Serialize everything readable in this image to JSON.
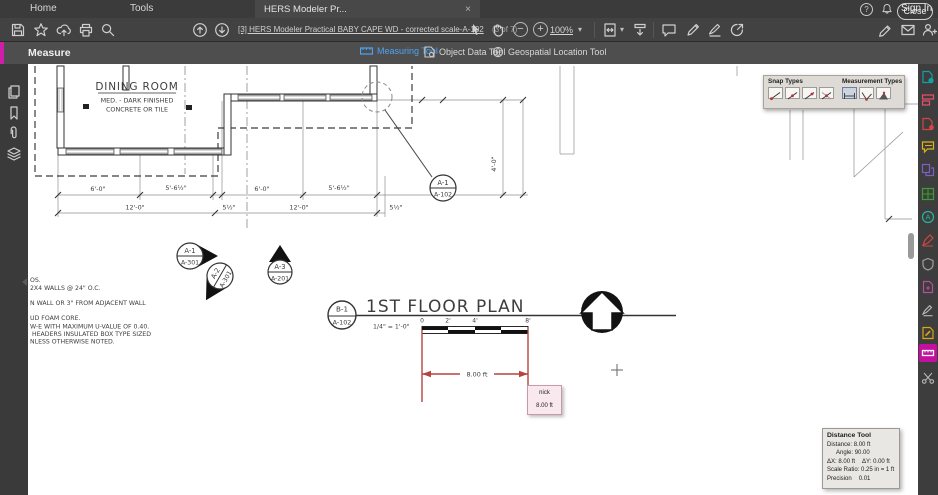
{
  "tabbar": {
    "home": "Home",
    "tools": "Tools",
    "tab_title": "HERS Modeler Pr...",
    "tab_close": "×",
    "sign_in": "Sign In"
  },
  "toolbar": {
    "doc_title": "[3] HERS Modeler Practical BABY CAPE WD - corrected scale-A-102",
    "page_info": "(3 of 7)",
    "zoom_level": "100%"
  },
  "icons": {
    "zoom_out": "−",
    "zoom_in": "+",
    "caret_down": "▾",
    "help": "?"
  },
  "measurebar": {
    "label": "Measure",
    "measuring_tool": "Measuring Tool",
    "object_data_tool": "Object Data Tool",
    "geospatial_tool": "Geospatial Location Tool",
    "close": "Close"
  },
  "snap_panel": {
    "snap_title": "Snap Types",
    "measurement_title": "Measurement Types"
  },
  "plan": {
    "room_name": "DINING ROOM",
    "room_desc_1": "MED. - DARK FINISHED",
    "room_desc_2": "CONCRETE OR TILE",
    "title": "1ST FLOOR PLAN",
    "scale_note": "1/4\" = 1'-0\"",
    "scale_ticks": [
      "0",
      "2'",
      "4'",
      "8'"
    ],
    "dims_row1": [
      "6'-0\"",
      "5'-6½\"",
      "6'-0\"",
      "5'-6½\""
    ],
    "dims_row2": [
      "12'-0\"",
      "5½\"",
      "12'-0\"",
      "5½\""
    ],
    "dim_vertical": "4'-0\"",
    "markers": [
      {
        "top": "A-1",
        "bottom": "A-301"
      },
      {
        "top": "A-2",
        "bottom": "A-301"
      },
      {
        "top": "A-3",
        "bottom": "A-201"
      },
      {
        "top": "A-1",
        "bottom": "A-102"
      },
      {
        "top": "B-1",
        "bottom": "A-102"
      }
    ],
    "notes": [
      "OS.",
      "2X4 WALLS @ 24\" O.C.",
      "N WALL OR 3\" FROM ADJACENT WALL",
      "UD FOAM CORE.",
      "W-E WITH MAXIMUM U-VALUE OF 0.40.",
      "HEADERS INSULATED BOX TYPE SIZED",
      "NLESS OTHERWISE NOTED."
    ],
    "measure_label": "8.00 ft"
  },
  "tooltip": {
    "author": "nick",
    "value": "8.00 ft"
  },
  "distance_panel": {
    "title": "Distance Tool",
    "distance_label": "Distance:",
    "distance_value": "8.00 ft",
    "angle_label": "Angle:",
    "angle_value": "90.00",
    "dx_label": "ΔX:",
    "dx_value": "8.00 ft",
    "dy_label": "ΔY:",
    "dy_value": "0.00 ft",
    "scale_label": "Scale Ratio:",
    "scale_value": "0.25 in = 1 ft",
    "precision_label": "Precision",
    "precision_value": "0.01"
  }
}
